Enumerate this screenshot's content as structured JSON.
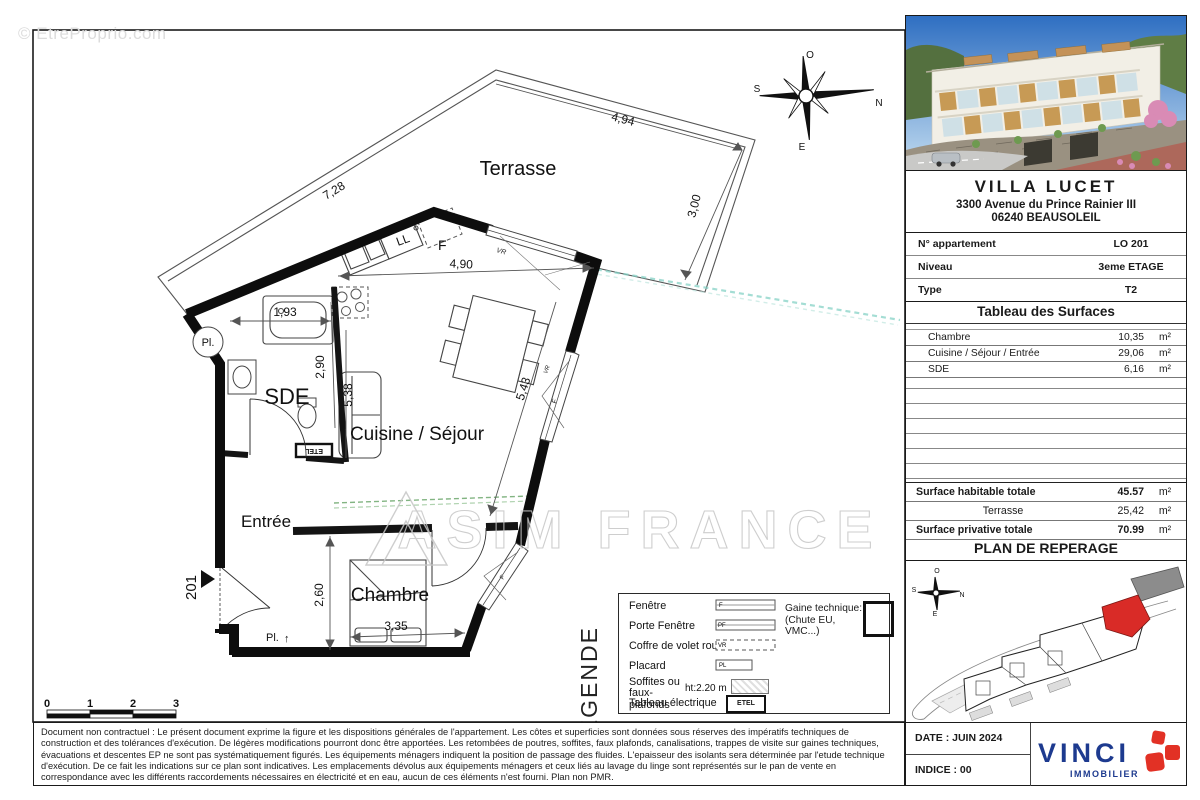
{
  "watermarks": {
    "top_left": "© EtreProprio.com",
    "center": "ASIM FRANCE"
  },
  "plan": {
    "rooms": {
      "terrasse": "Terrasse",
      "cuisine": "Cuisine / Séjour",
      "sde": "SDE",
      "entree": "Entrée",
      "chambre": "Chambre"
    },
    "dims": {
      "d728": "7,28",
      "d494": "4,94",
      "d300": "3,00",
      "d490": "4,90",
      "d543": "5,43",
      "d538": "5,38",
      "d290": "2,90",
      "d193": "1,93",
      "d260": "2,60",
      "d335": "3,35"
    },
    "tags": {
      "unit": "201",
      "pl": "Pl.",
      "pl2": "Pl.",
      "arrow_up": "↑",
      "ll": "LL",
      "f_kitchen": "F",
      "vr_top": "VR",
      "vr_right": "VR",
      "f_right": "F",
      "f_low": "F",
      "etel": "ETEL"
    },
    "compass": {
      "o": "O",
      "s": "S",
      "n": "N",
      "e": "E"
    },
    "scale": [
      "0",
      "1",
      "2",
      "3"
    ]
  },
  "panel": {
    "address": {
      "title": "VILLA LUCET",
      "line1": "3300 Avenue du Prince Rainier III",
      "line2": "06240 BEAUSOLEIL"
    },
    "info_rows": [
      {
        "label": "N° appartement",
        "value": "LO 201"
      },
      {
        "label": "Niveau",
        "value": "3eme ETAGE"
      },
      {
        "label": "Type",
        "value": "T2"
      }
    ],
    "surfaces_title": "Tableau des Surfaces",
    "surface_rows": [
      {
        "label": "Chambre",
        "value": "10,35",
        "unit": "m²"
      },
      {
        "label": "Cuisine / Séjour / Entrée",
        "value": "29,06",
        "unit": "m²"
      },
      {
        "label": "SDE",
        "value": "6,16",
        "unit": "m²"
      }
    ],
    "totals": [
      {
        "label": "Surface habitable totale",
        "value": "45.57",
        "unit": "m²"
      },
      {
        "label": "Terrasse",
        "value": "25,42",
        "unit": "m²"
      },
      {
        "label": "Surface privative totale",
        "value": "70.99",
        "unit": "m²"
      }
    ],
    "reperage_title": "PLAN DE REPERAGE",
    "site_compass": {
      "o": "O",
      "s": "S",
      "n": "N",
      "e": "E"
    },
    "date": "DATE : JUIN 2024",
    "indice": "INDICE : 00",
    "logo": {
      "name": "VINCI",
      "sub": "IMMOBILIER"
    }
  },
  "legend": {
    "title": "LEGENDE",
    "items": [
      {
        "label": "Fenêtre",
        "tag": "F"
      },
      {
        "label": "Porte Fenêtre",
        "tag": "PF"
      },
      {
        "label": "Coffre de volet roulant",
        "tag": "VR"
      },
      {
        "label": "Placard",
        "tag": "PL"
      },
      {
        "label": "Soffites ou faux-plafonds",
        "tag": "ht:2.20 m"
      },
      {
        "label": "Tableau électrique",
        "tag": "ETEL"
      }
    ],
    "gaine_label": "Gaine technique:",
    "gaine_sub": "(Chute EU, VMC...)"
  },
  "legal": {
    "text": "Document non contractuel : Le présent document exprime la figure et les dispositions générales de l'appartement. Les côtes et superficies sont données sous réserves des impératifs techniques de construction et des tolérances d'exécution. De légères modifications pourront donc être apportées. Les retombées de poutres, soffites, faux plafonds, canalisations, trappes de visite sur gaines techniques, évacuations et descentes EP ne sont pas systématiquement figurés. Les équipements ménagers indiquent la position de passage des fluides. L'epaisseur des isolants sera déterminée par l'etude technique d'exécution. De ce fait les indications sur ce plan sont indicatives. Les emplacements dévolus aux équipements ménagers et ceux liés au lavage du linge sont représentés sur le pan de vente en correspondance avec les différents raccordements nécessaires en électricité et en eau, aucun de ces éléments n'est fourni.",
    "footnote": "Plan non PMR."
  }
}
